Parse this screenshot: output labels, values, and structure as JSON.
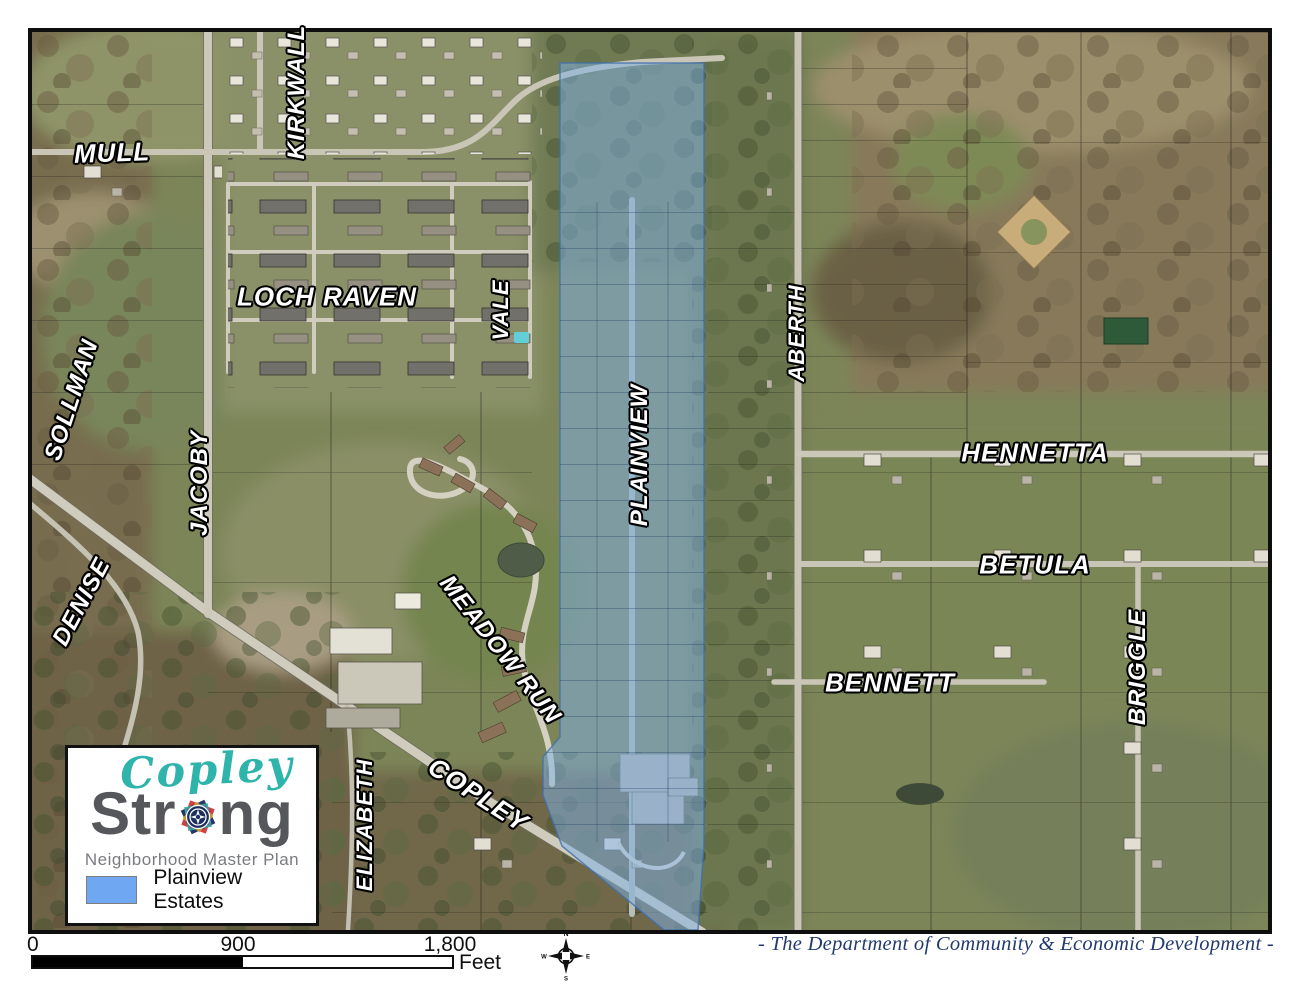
{
  "map": {
    "street_labels": [
      {
        "text": "MULL"
      },
      {
        "text": "KIRKWALL"
      },
      {
        "text": "LOCH RAVEN"
      },
      {
        "text": "VALE"
      },
      {
        "text": "SOLLMAN"
      },
      {
        "text": "JACOBY"
      },
      {
        "text": "DENISE"
      },
      {
        "text": "MEADOW RUN"
      },
      {
        "text": "PLAINVIEW"
      },
      {
        "text": "ABERTH"
      },
      {
        "text": "HENNETTA"
      },
      {
        "text": "BETULA"
      },
      {
        "text": "BENNETT"
      },
      {
        "text": "BRIGGLE"
      },
      {
        "text": "ELIZABETH"
      },
      {
        "text": "COPLEY"
      }
    ],
    "highlight": {
      "name": "Plainview Estates",
      "color": "#7FB1E4"
    }
  },
  "logo": {
    "title_script": "Copley",
    "title_bold_pre": "Str",
    "title_bold_post": "ng",
    "tagline": "Neighborhood Master Plan",
    "accent_teal": "#2EB4AB",
    "accent_gray": "#56575B"
  },
  "legend": {
    "swatch_color": "#6FA7F2",
    "label": "Plainview Estates"
  },
  "scale_bar": {
    "ticks": [
      "0",
      "900",
      "1,800"
    ],
    "unit": "Feet"
  },
  "compass": {
    "n": "N",
    "e": "E",
    "s": "S",
    "w": "W"
  },
  "credit": "- The Department of Community & Economic Development -"
}
